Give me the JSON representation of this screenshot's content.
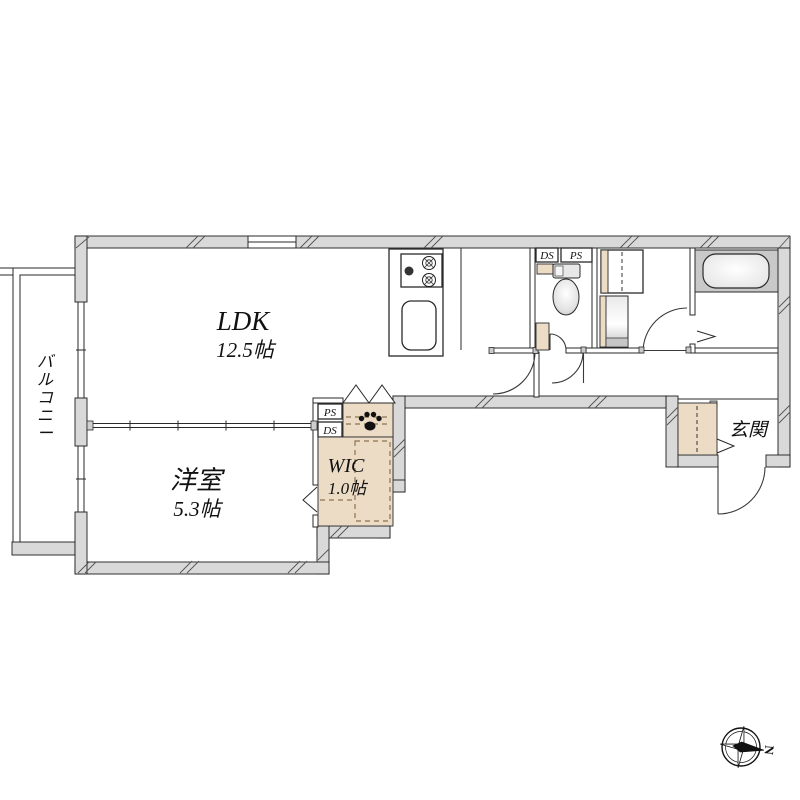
{
  "plan": {
    "rooms": {
      "ldk": {
        "label": "LDK",
        "area": "12.5帖"
      },
      "youshitsu": {
        "label": "洋室",
        "area": "5.3帖"
      },
      "wic": {
        "label": "WIC",
        "area": "1.0帖"
      },
      "genkan": {
        "label": "玄関"
      },
      "balcony": {
        "label": "バルコニー"
      }
    },
    "shafts": {
      "toilet_ds": "DS",
      "toilet_ps": "PS",
      "wic_ps": "PS",
      "wic_ds": "DS"
    },
    "compass": {
      "north_label": "N"
    },
    "fixtures": [
      "stove",
      "sink",
      "toilet",
      "bathtub",
      "washer-space",
      "vanity",
      "shoe-cabinet",
      "pet-paw"
    ],
    "colors": {
      "wall": "#d9d9d9",
      "closet": "#ecdcc6",
      "outline": "#1b1b1b",
      "dashed_accent": "#8a7450",
      "bath_zone": "#c9c9c9"
    }
  }
}
